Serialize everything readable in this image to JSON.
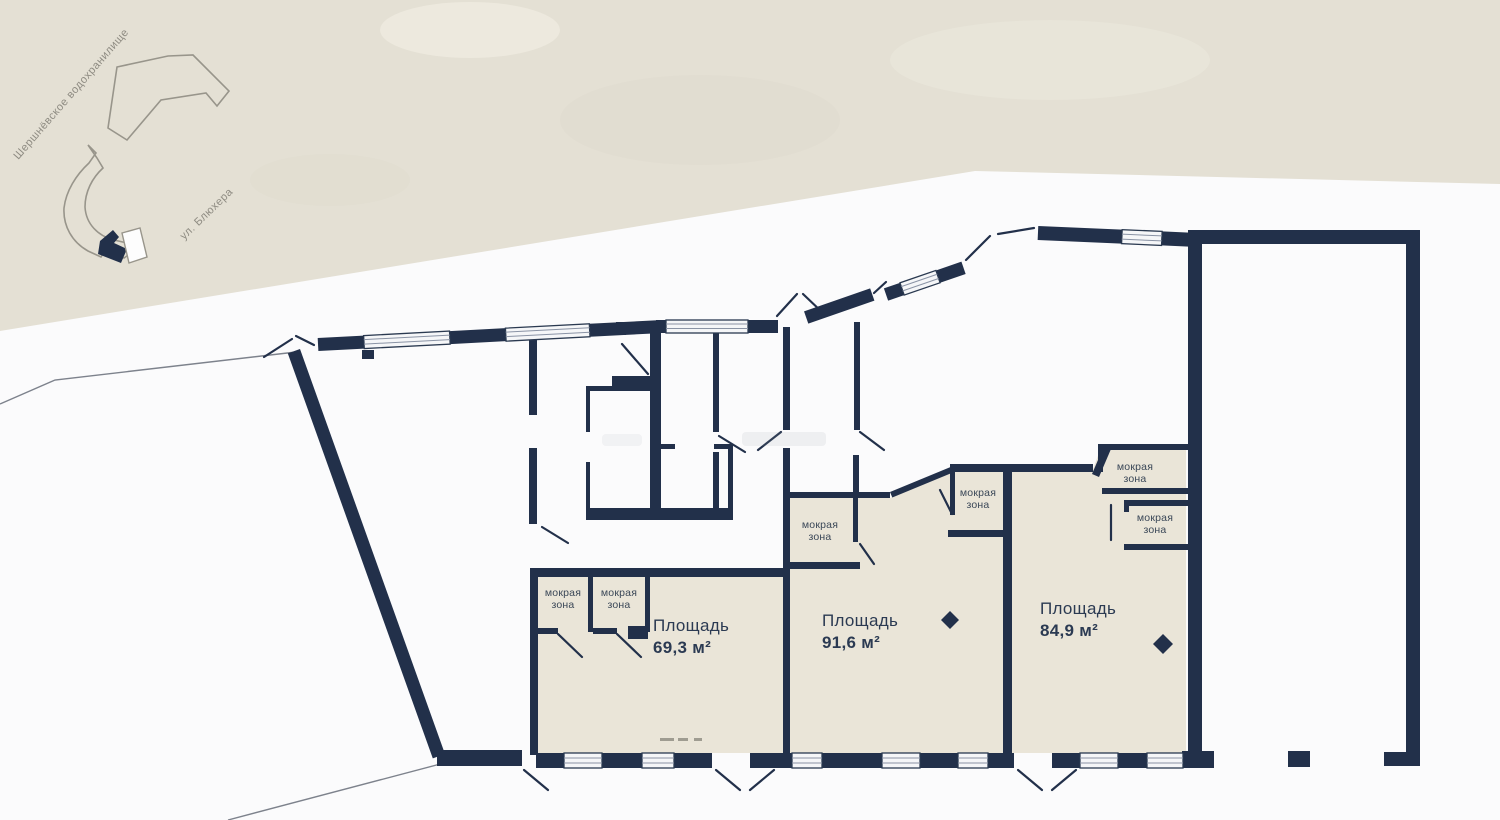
{
  "map": {
    "reservoir_label": "Шершнёвское водохранилище",
    "street_label": "ул. Блюхера"
  },
  "plan": {
    "rooms": [
      {
        "label": "Площадь",
        "area": "69,3 м²"
      },
      {
        "label": "Площадь",
        "area": "91,6 м²"
      },
      {
        "label": "Площадь",
        "area": "84,9 м²"
      }
    ],
    "wet_zone": {
      "line1": "мокрая",
      "line2": "зона"
    }
  },
  "colors": {
    "wall": "#22304a",
    "floor": "#eae5d8",
    "beige": "#e4e0d4",
    "white": "#fbfbfc",
    "map_outline": "#98958b",
    "label": "#2b3a52"
  }
}
